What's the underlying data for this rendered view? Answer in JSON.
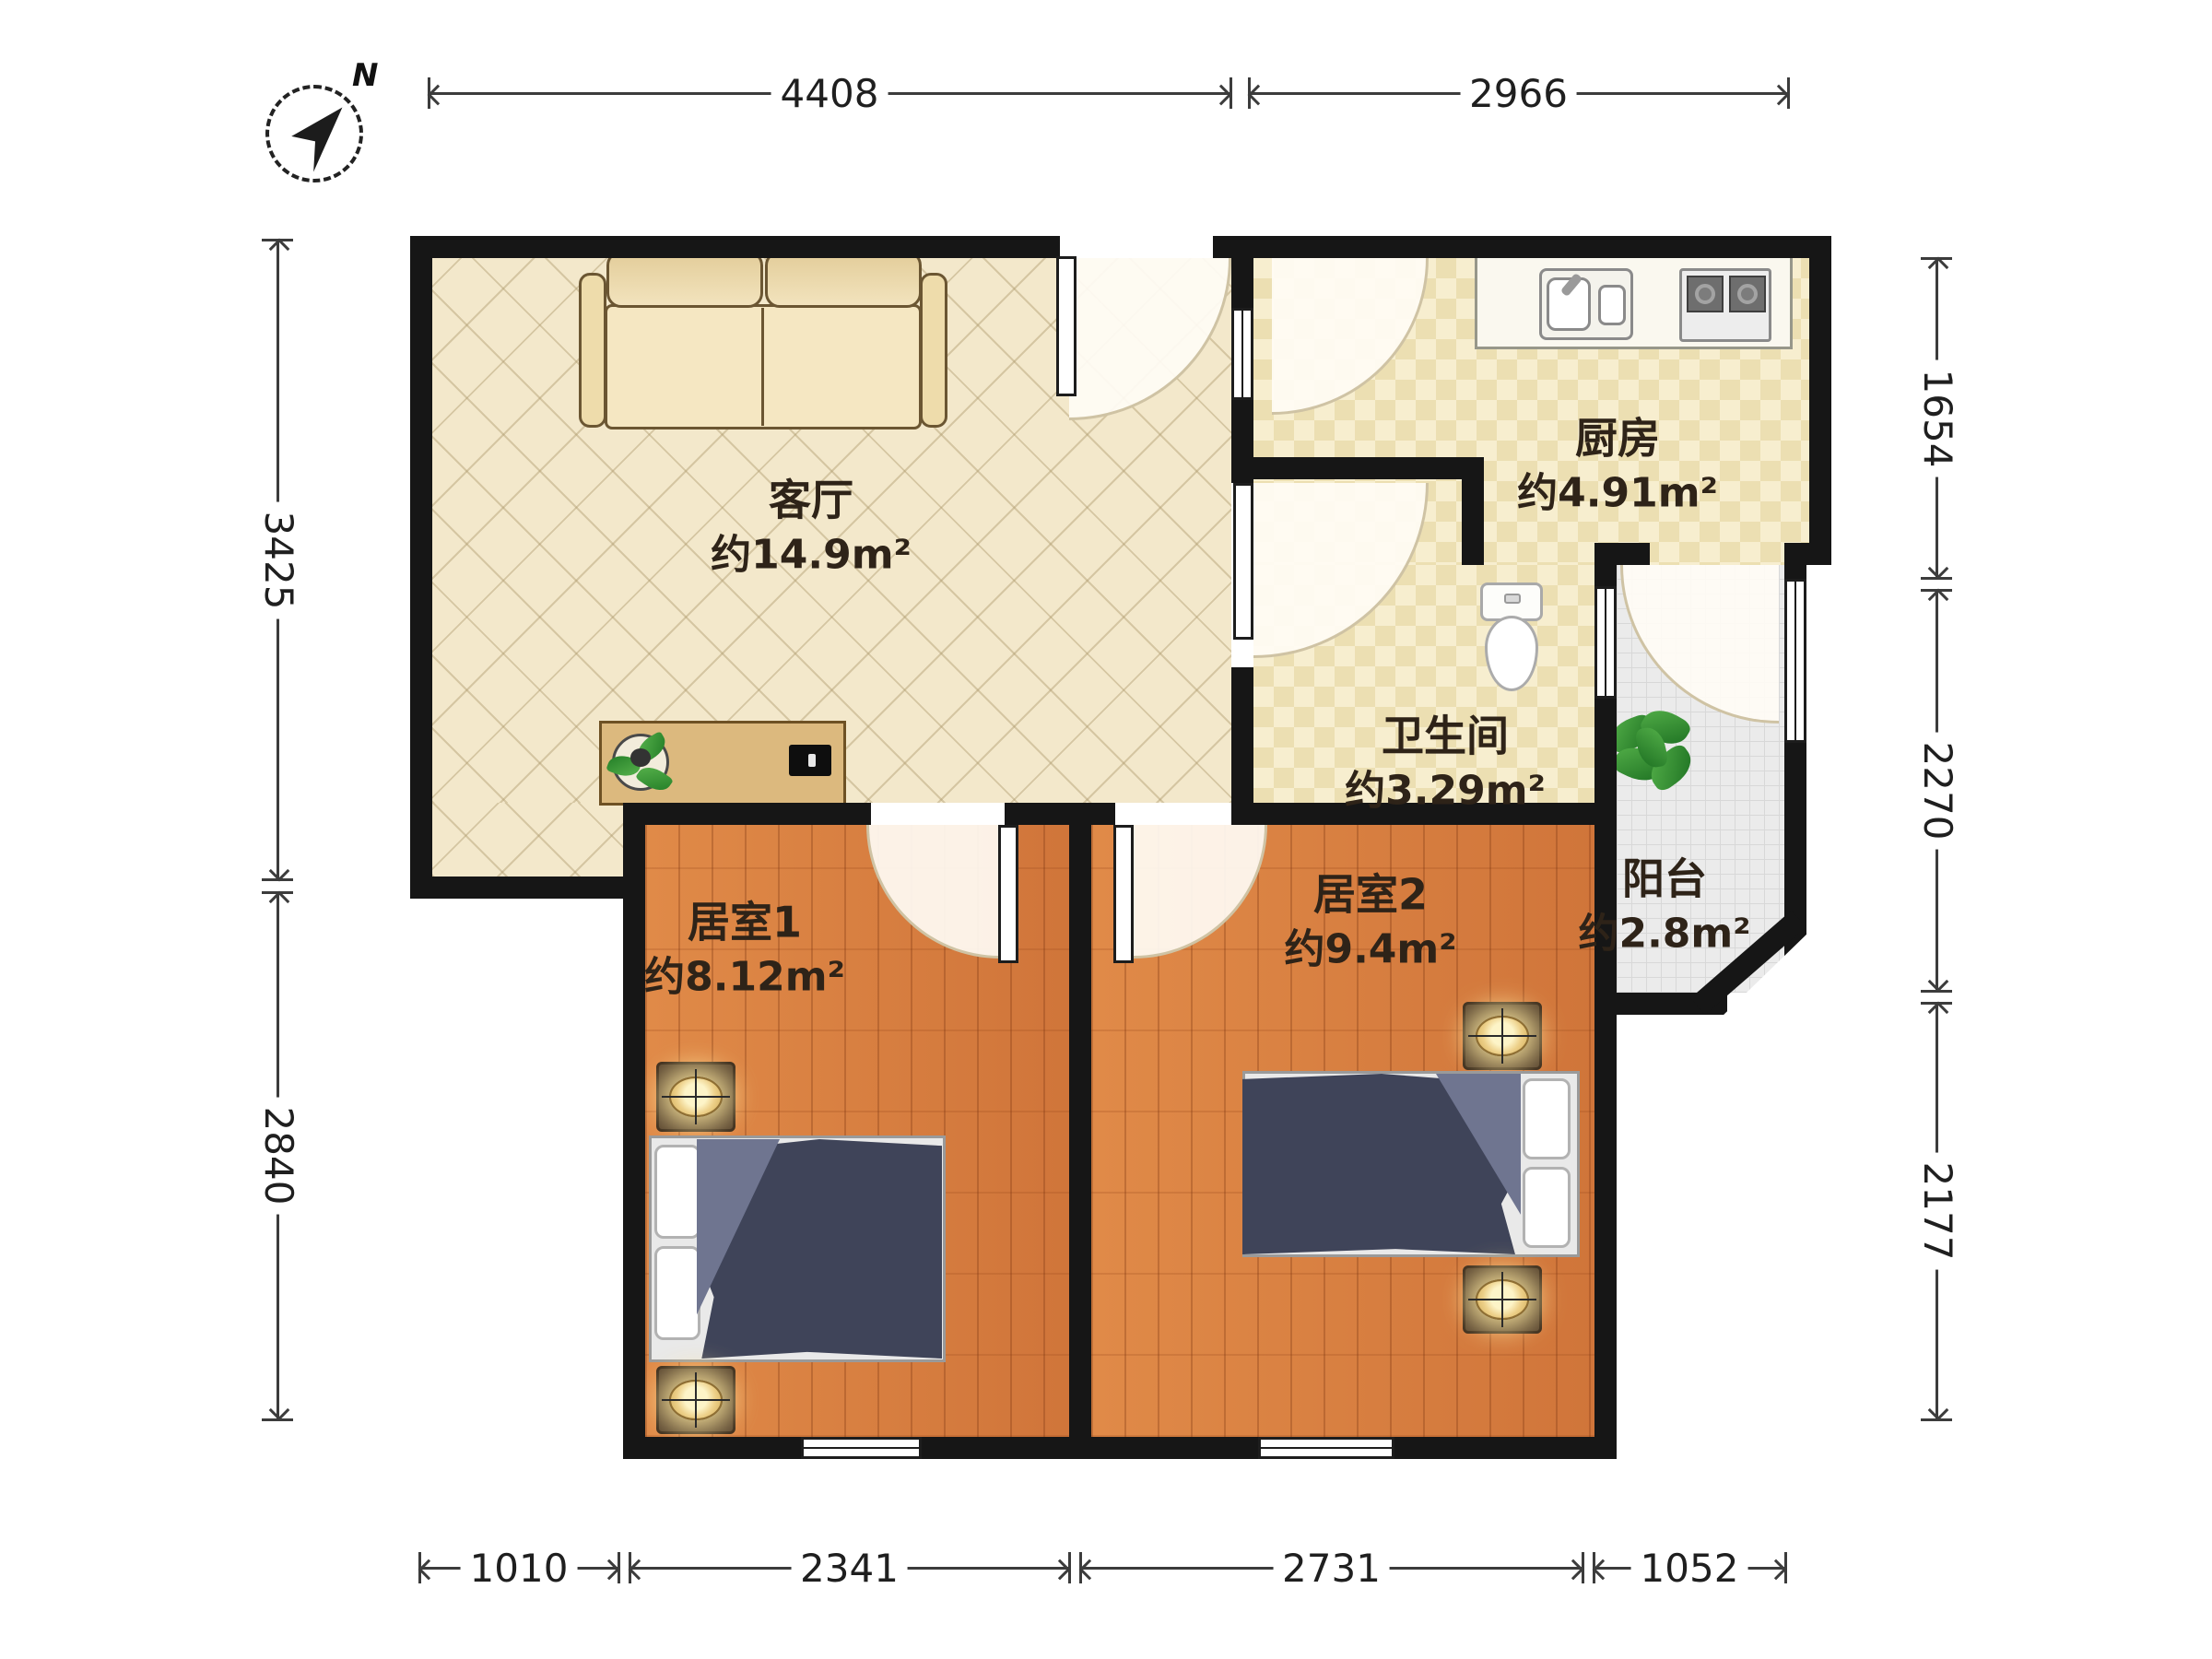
{
  "compass": {
    "label": "N"
  },
  "rooms": {
    "living": {
      "name": "客厅",
      "area": "约14.9m²"
    },
    "kitchen": {
      "name": "厨房",
      "area": "约4.91m²"
    },
    "bathroom": {
      "name": "卫生间",
      "area": "约3.29m²"
    },
    "bedroom1": {
      "name": "居室1",
      "area": "约8.12m²"
    },
    "bedroom2": {
      "name": "居室2",
      "area": "约9.4m²"
    },
    "balcony": {
      "name": "阳台",
      "area": "约2.8m²"
    }
  },
  "dimensions": {
    "top": [
      "4408",
      "2966"
    ],
    "left": [
      "3425",
      "2840"
    ],
    "right": [
      "1654",
      "2270",
      "2177"
    ],
    "bottom": [
      "1010",
      "2341",
      "2731",
      "1052"
    ]
  },
  "furniture": [
    "sofa",
    "tv-console",
    "potted-plant",
    "tv",
    "kitchen-sink",
    "stove",
    "toilet",
    "balcony-plant",
    "bed",
    "pillow",
    "nightstand-lamp"
  ],
  "colors": {
    "wall": "#161616",
    "living_floor": "#f3e8cb",
    "tile_floor": "#efe3bb",
    "wood_floor": "#d8803e",
    "balcony_floor": "#ebebeb",
    "duvet": "#3f4459",
    "lamp": "#edd089"
  }
}
